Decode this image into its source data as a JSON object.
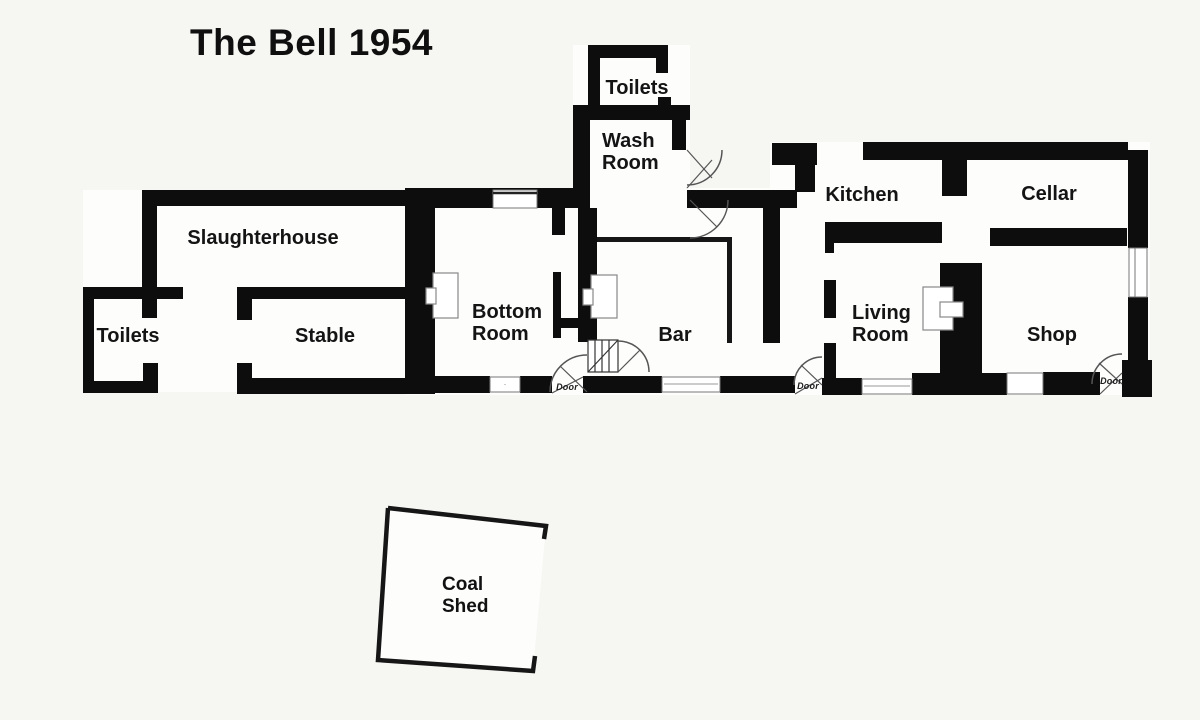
{
  "title": "The Bell 1954",
  "labels": {
    "door": "Door"
  },
  "rooms": {
    "slaughterhouse": "Slaughterhouse",
    "toilets_left": "Toilets",
    "stable": "Stable",
    "toilets_top": "Toilets",
    "wash_room": "Wash\nRoom",
    "bottom_room": "Bottom\nRoom",
    "bar": "Bar",
    "kitchen": "Kitchen",
    "cellar": "Cellar",
    "living_room": "Living\nRoom",
    "shop": "Shop",
    "coal_shed": "Coal\nShed"
  },
  "colors": {
    "wall": "#0d0d0d",
    "background": "#f6f6f3",
    "paper": "#fdfdfc",
    "arc": "#555555"
  }
}
